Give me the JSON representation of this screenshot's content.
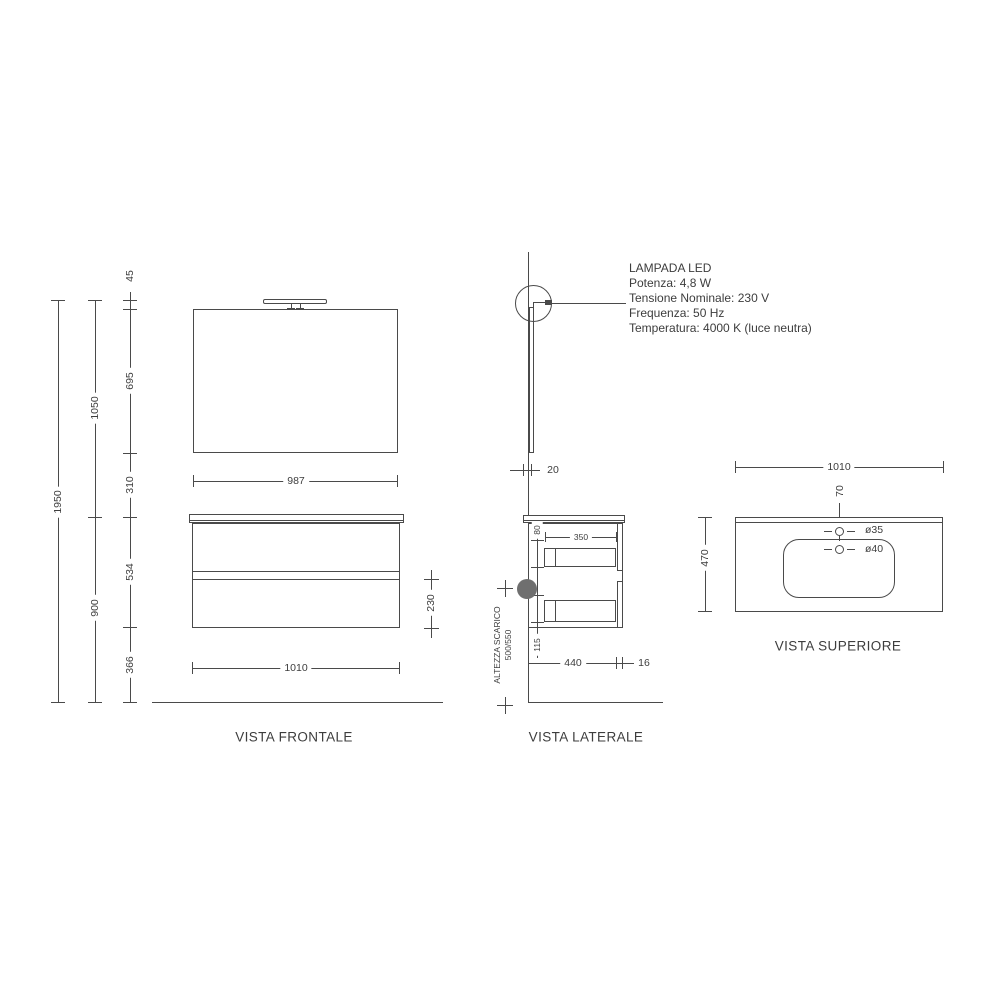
{
  "front": {
    "label": "VISTA FRONTALE",
    "mirror_width": "987",
    "cabinet_width": "1010",
    "drawer_front_height": "230"
  },
  "side": {
    "label": "VISTA LATERALE",
    "mirror_thickness": "20",
    "cabinet_depth": "440",
    "front_panel_thickness": "16",
    "drawer_inner_depth": "350",
    "top_clearance": "80",
    "bottom_clearance": "115",
    "drain_note_line1": "ALTEZZA SCARICO",
    "drain_note_line2": "500/550"
  },
  "top": {
    "label": "VISTA SUPERIORE",
    "counter_width": "1010",
    "counter_depth": "470",
    "tap_offset": "70",
    "tap_hole_diameter": "ø35",
    "drain_hole_diameter": "ø40"
  },
  "heights": {
    "total": "1950",
    "upper_zone": "1050",
    "lower_zone": "900",
    "lamp": "45",
    "mirror": "695",
    "gap": "310",
    "cabinet": "534",
    "floor_clearance": "366"
  },
  "lamp": {
    "title": "LAMPADA LED",
    "specs": [
      "Potenza: 4,8 W",
      "Tensione Nominale: 230 V",
      "Frequenza: 50 Hz",
      "Temperatura: 4000 K (luce neutra)"
    ]
  },
  "colors": {
    "line": "#4a4a4a",
    "text": "#3d3d3d",
    "drain_dot": "#6f6f6f"
  }
}
